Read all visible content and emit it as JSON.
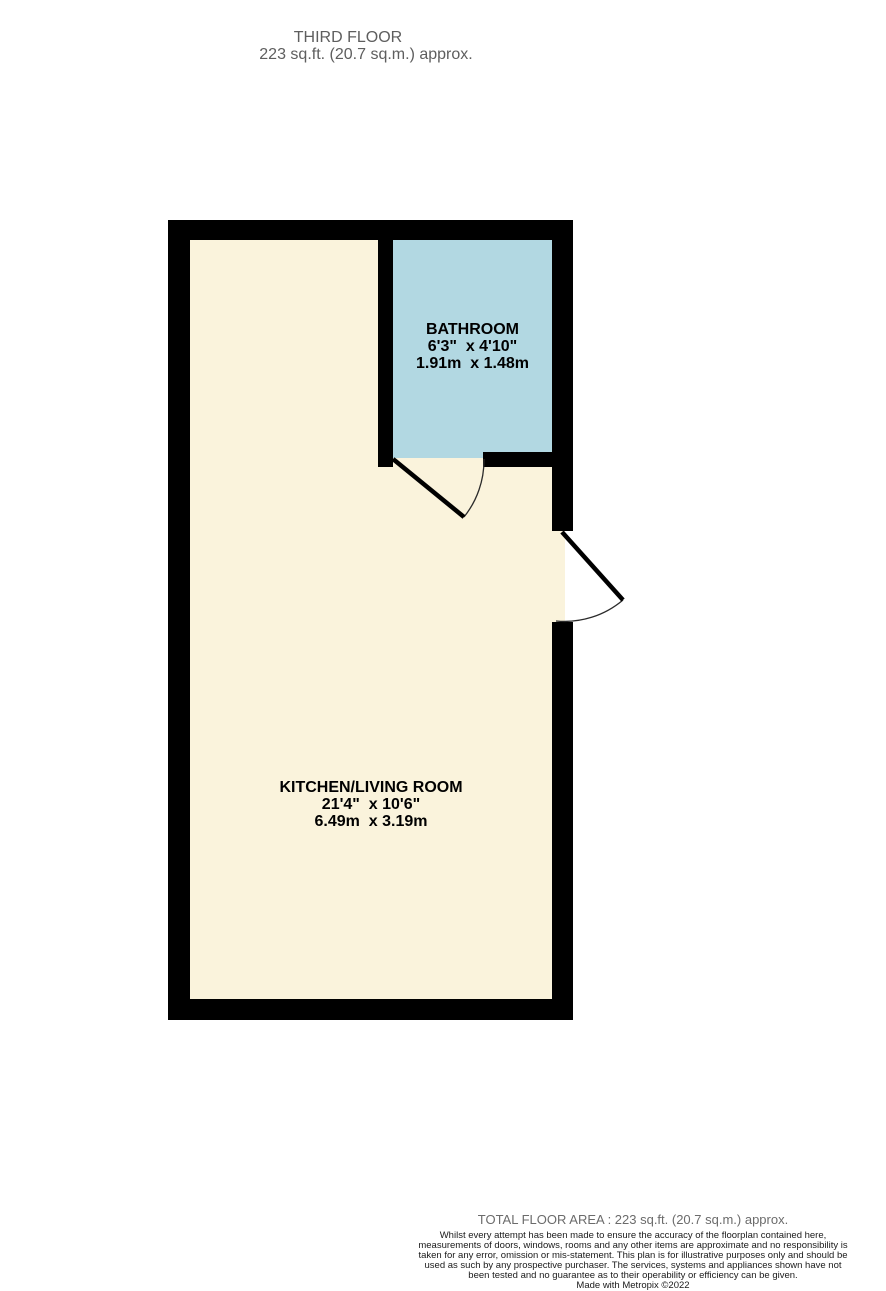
{
  "header": {
    "floor_title": "THIRD FLOOR",
    "floor_area": "223 sq.ft. (20.7 sq.m.) approx."
  },
  "floorplan": {
    "colors": {
      "wall": "#000000",
      "kitchen_living_floor": "#FAF3DC",
      "bathroom_floor": "#B2D8E2",
      "door_line": "#000000",
      "swing_arc": "#2b2b2b"
    },
    "rooms": [
      {
        "id": "bathroom",
        "name": "BATHROOM",
        "dims_imperial": "6'3\"  x 4'10\"",
        "dims_metric": "1.91m  x 1.48m"
      },
      {
        "id": "kitchen-living-room",
        "name": "KITCHEN/LIVING ROOM",
        "dims_imperial": "21'4\"  x 10'6\"",
        "dims_metric": "6.49m  x 3.19m"
      }
    ]
  },
  "footer": {
    "total_area": "TOTAL FLOOR AREA : 223 sq.ft. (20.7 sq.m.) approx.",
    "disclaimer": "Whilst every attempt has been made to ensure the accuracy of the floorplan contained here, measurements of doors, windows, rooms and any other items are approximate and no responsibility is taken for any error, omission or mis-statement. This plan is for illustrative purposes only and should be used as such by any prospective purchaser. The services, systems and appliances shown have not been tested and no guarantee as to their operability or efficiency can be given.",
    "credit": "Made with Metropix ©2022"
  }
}
